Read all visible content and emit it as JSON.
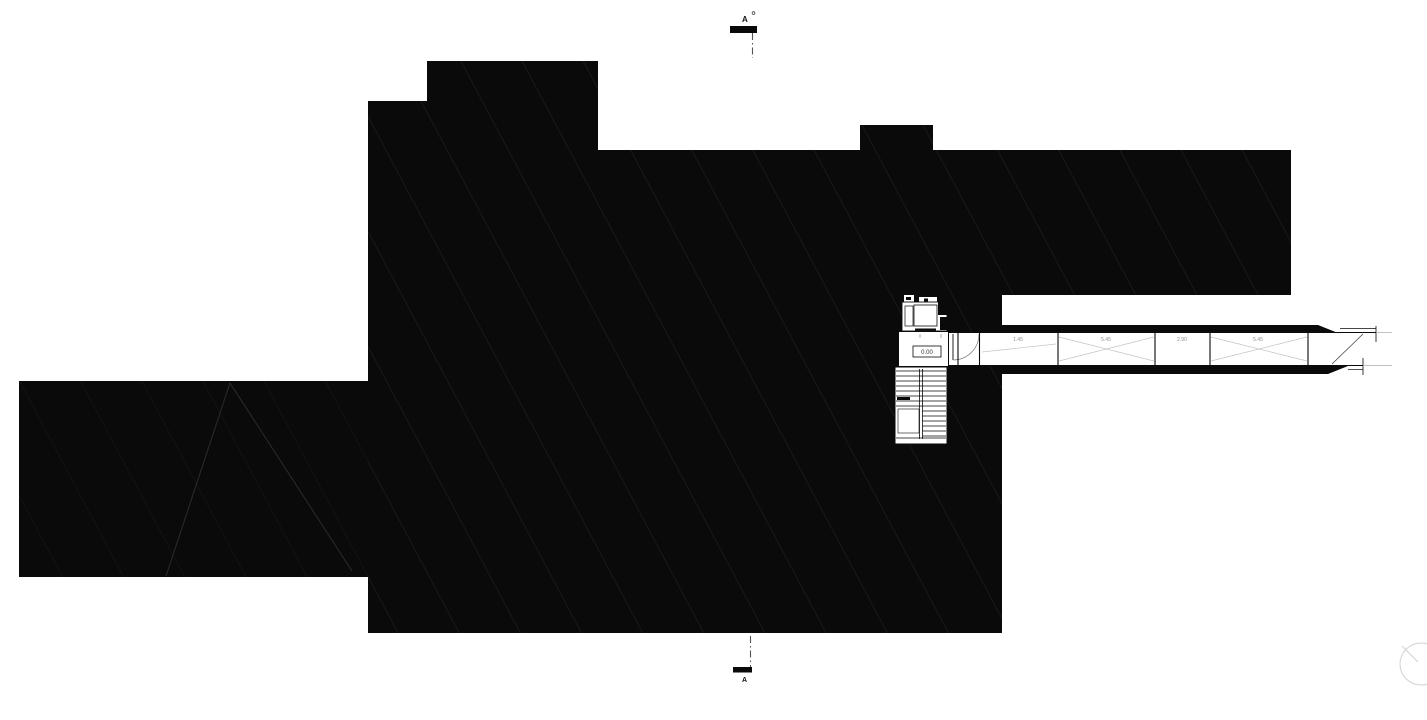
{
  "section_markers": {
    "top_label": "A",
    "bottom_label": "A"
  },
  "core": {
    "level_label": "0.00"
  },
  "corridor": {
    "dimensions": [
      "1.45",
      "5.45",
      "2.90",
      "5.45"
    ]
  },
  "colors": {
    "background": "#ffffff",
    "ink": "#0a0a0a",
    "hatch_line": "#242424",
    "ridge_line": "#2c2c2c",
    "faint_line": "#c4c4c4",
    "dim_text": "#8f8f8f",
    "north_symbol": "#d2d2d2"
  }
}
